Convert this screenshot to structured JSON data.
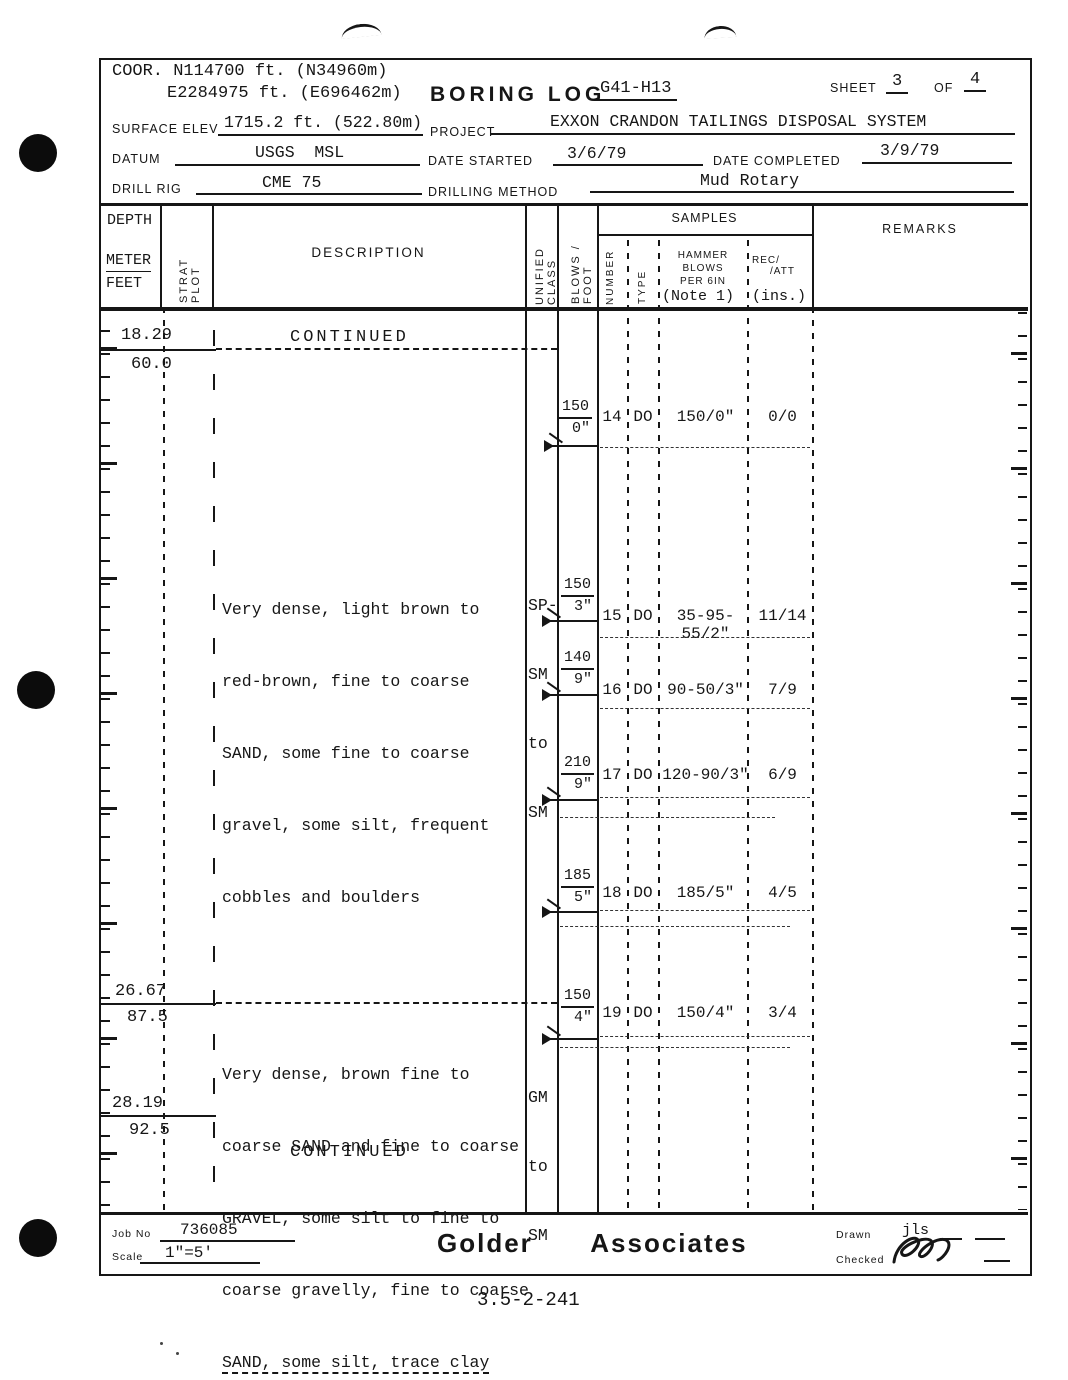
{
  "header": {
    "coor_line1": "COOR. N114700 ft. (N34960m)",
    "coor_line2": "E2284975 ft. (E696462m)",
    "title": "BORING LOG",
    "boring_id": "G41-H13",
    "sheet_label": "SHEET",
    "sheet_no": "3",
    "of_label": "OF",
    "sheet_total": "4",
    "surface_elev_label": "SURFACE ELEV",
    "surface_elev": "1715.2 ft. (522.80m)",
    "project_label": "PROJECT",
    "project": "EXXON CRANDON TAILINGS DISPOSAL SYSTEM",
    "datum_label": "DATUM",
    "datum": "USGS  MSL",
    "date_started_label": "DATE STARTED",
    "date_started": "3/6/79",
    "date_completed_label": "DATE COMPLETED",
    "date_completed": "3/9/79",
    "drill_rig_label": "DRILL RIG",
    "drill_rig": "CME 75",
    "drilling_method_label": "DRILLING METHOD",
    "drilling_method": "Mud Rotary"
  },
  "columns": {
    "depth": "DEPTH",
    "meter": "METER",
    "feet": "FEET",
    "strat_plot": "STRAT  PLOT",
    "description": "DESCRIPTION",
    "unified_class": "UNIFIED CLASS",
    "blows_foot": "BLOWS / FOOT",
    "samples": "SAMPLES",
    "number": "NUMBER",
    "type": "TYPE",
    "hammer_l1": "HAMMER",
    "hammer_l2": "BLOWS",
    "hammer_l3": "PER 6IN",
    "hammer_note": "(Note 1)",
    "rec_att_l1": "REC/",
    "rec_att_l2": "/ATT",
    "rec_att_units": "(ins.)",
    "remarks": "REMARKS"
  },
  "log": {
    "continued_top": "CONTINUED",
    "continued_bottom": "CONTINUED",
    "depths": [
      {
        "meters": "18.29",
        "feet": "60.0"
      },
      {
        "meters": "26.67",
        "feet": "87.5"
      },
      {
        "meters": "28.19",
        "feet": "92.5"
      }
    ],
    "strata": [
      {
        "lines": [
          "Very dense, light brown to",
          "red-brown, fine to coarse",
          "SAND, some fine to coarse",
          "gravel, some silt, frequent",
          "cobbles and boulders"
        ],
        "unified_lines": [
          "SP-",
          "SM",
          "to",
          "SM"
        ]
      },
      {
        "lines": [
          "Very dense, brown fine to",
          "coarse SAND and fine to coarse",
          "GRAVEL, some silt to fine to",
          "coarse gravelly, fine to coarse",
          "SAND, some silt, trace clay"
        ],
        "unified_lines": [
          "GM",
          "to",
          "SM"
        ]
      }
    ],
    "samples": [
      {
        "blows_foot": "150",
        "blows_inches": "0\"",
        "number": "14",
        "type": "DO",
        "hammer_blows": "150/0\"",
        "rec_att": "0/0"
      },
      {
        "blows_foot": "150",
        "blows_inches": "3\"",
        "number": "15",
        "type": "DO",
        "hammer_blows": "35-95-55/2\"",
        "rec_att": "11/14"
      },
      {
        "blows_foot": "140",
        "blows_inches": "9\"",
        "number": "16",
        "type": "DO",
        "hammer_blows": "90-50/3\"",
        "rec_att": "7/9"
      },
      {
        "blows_foot": "210",
        "blows_inches": "9\"",
        "number": "17",
        "type": "DO",
        "hammer_blows": "120-90/3\"",
        "rec_att": "6/9"
      },
      {
        "blows_foot": "185",
        "blows_inches": "5\"",
        "number": "18",
        "type": "DO",
        "hammer_blows": "185/5\"",
        "rec_att": "4/5"
      },
      {
        "blows_foot": "150",
        "blows_inches": "4\"",
        "number": "19",
        "type": "DO",
        "hammer_blows": "150/4\"",
        "rec_att": "3/4"
      }
    ]
  },
  "footer": {
    "job_no_label": "Job No",
    "job_no": "736085",
    "scale_label": "Scale",
    "scale": "1\"=5'",
    "company": "Golder  Associates",
    "drawn_label": "Drawn",
    "drawn": "jls",
    "checked_label": "Checked",
    "page_ref": "3.5-2-241"
  }
}
